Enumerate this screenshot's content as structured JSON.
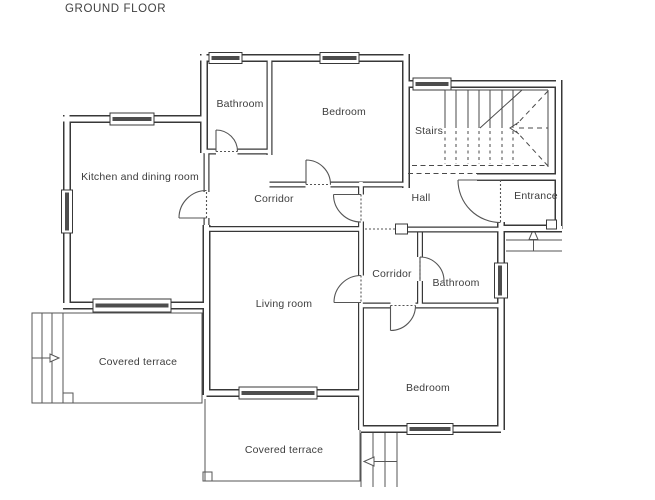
{
  "title": "GROUND FLOOR",
  "rooms": {
    "bathroom_top": "Bathroom",
    "bedroom_top": "Bedroom",
    "stairs": "Stairs",
    "kitchen": "Kitchen and dining room",
    "corridor_top": "Corridor",
    "hall": "Hall",
    "entrance": "Entrance",
    "corridor_lower": "Corridor",
    "bathroom_lower": "Bathroom",
    "living_room": "Living room",
    "terrace_left": "Covered terrace",
    "bedroom_lower": "Bedroom",
    "terrace_bottom": "Covered terrace"
  },
  "colors": {
    "background": "#ffffff",
    "wall_line": "#383838",
    "thin_line": "#555555",
    "text": "#3d3d3d",
    "window_slab": "#4d4d4d"
  }
}
